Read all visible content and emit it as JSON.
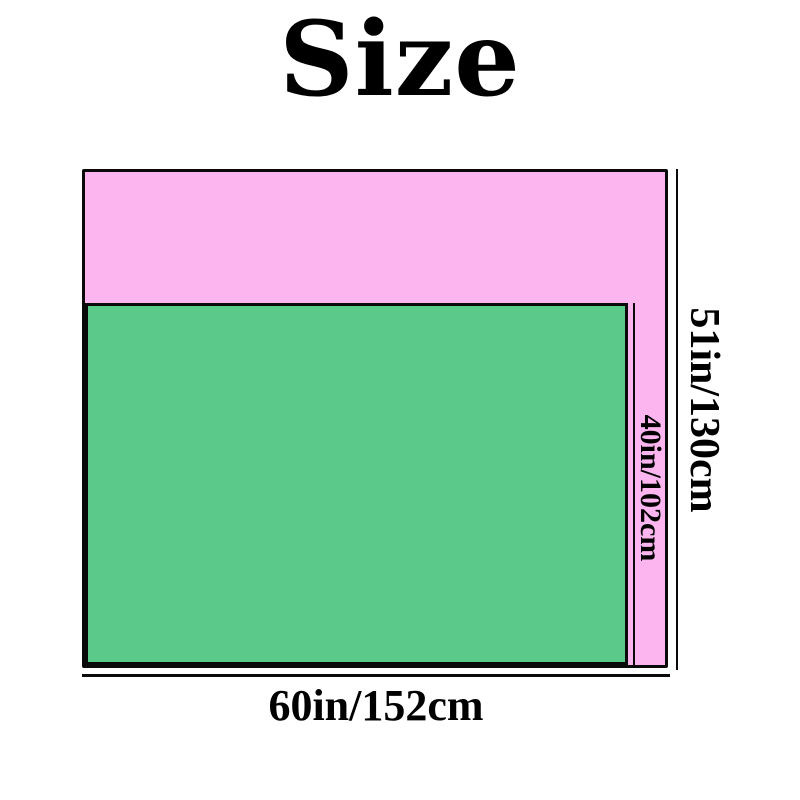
{
  "page": {
    "background": "#ffffff",
    "line_color": "#0a0a0a"
  },
  "title": {
    "text": "Size"
  },
  "size_chart": {
    "outer_rect": {
      "fill": "#fcb5ef",
      "border_color": "#0a0a0a",
      "width_label": "60in/152cm",
      "height_label": "51in/130cm"
    },
    "inner_rect": {
      "fill": "#5bc989",
      "border_color": "#0a0a0a",
      "height_label": "40in/102cm"
    }
  }
}
